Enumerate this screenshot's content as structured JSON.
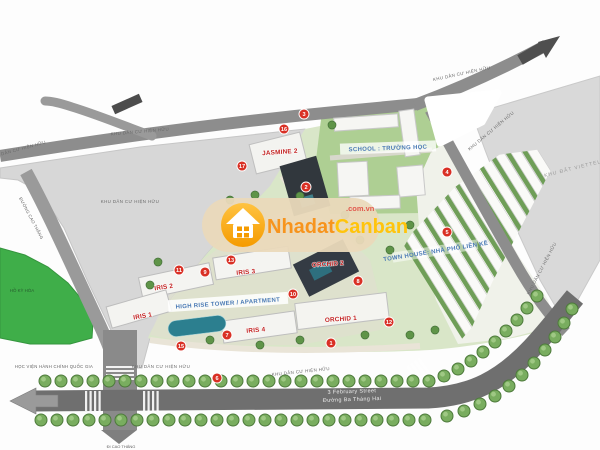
{
  "watermark": {
    "brand_part1": "Nhadat",
    "brand_part2": "Canban",
    "domain": ".com.vn",
    "icon": "house-icon"
  },
  "labels": {
    "existing_residential": "KHU DÂN CƯ HIỆN HỮU",
    "viettel_land": "KHU ĐẤT VIETTEL",
    "academy": "HỌC VIỆN HÀNH CHÍNH QUỐC GIA",
    "ky_hoa": "HỒ KỲ HÒA",
    "school": "SCHOOL : TRƯỜNG HỌC",
    "town_house": "TOWN HOUSE: NHÀ PHỐ LIỀN KỀ",
    "highrise": "HIGH RISE TOWER / APARTMENT",
    "street_en": "3 February Street",
    "street_vi": "Đường Ba Tháng Hai",
    "to_cao_thang": "ĐI CAO THẮNG",
    "cao_thang_road": "ĐƯỜNG CAO THẮNG"
  },
  "buildings": {
    "iris1": "IRIS 1",
    "iris2": "IRIS 2",
    "iris3": "IRIS 3",
    "iris4": "IRIS 4",
    "orchid1": "ORCHID 1",
    "orchid2": "ORCHID 2",
    "jasmine2": "JASMINE 2"
  },
  "markers": [
    {
      "n": "3",
      "x": 304,
      "y": 114
    },
    {
      "n": "16",
      "x": 284,
      "y": 129
    },
    {
      "n": "17",
      "x": 242,
      "y": 166
    },
    {
      "n": "2",
      "x": 306,
      "y": 187
    },
    {
      "n": "4",
      "x": 447,
      "y": 172
    },
    {
      "n": "5",
      "x": 447,
      "y": 232
    },
    {
      "n": "13",
      "x": 231,
      "y": 260
    },
    {
      "n": "11",
      "x": 179,
      "y": 270
    },
    {
      "n": "9",
      "x": 205,
      "y": 272
    },
    {
      "n": "10",
      "x": 293,
      "y": 294
    },
    {
      "n": "8",
      "x": 358,
      "y": 281
    },
    {
      "n": "12",
      "x": 389,
      "y": 322
    },
    {
      "n": "7",
      "x": 227,
      "y": 335
    },
    {
      "n": "15",
      "x": 181,
      "y": 346
    },
    {
      "n": "1",
      "x": 331,
      "y": 343
    },
    {
      "n": "6",
      "x": 217,
      "y": 378
    }
  ],
  "colors": {
    "marker_red": "#d93025",
    "label_red": "#c32222",
    "label_blue": "#4a7ab5",
    "road_gray": "#8d8d8d",
    "main_road_gray": "#6f6f6f",
    "zone_gray": "#d7d7d7",
    "park_green": "#3fae49",
    "tree_green": "#79ad5f",
    "watermark_orange": "#f7941d",
    "watermark_yellow": "#ffc40c"
  }
}
